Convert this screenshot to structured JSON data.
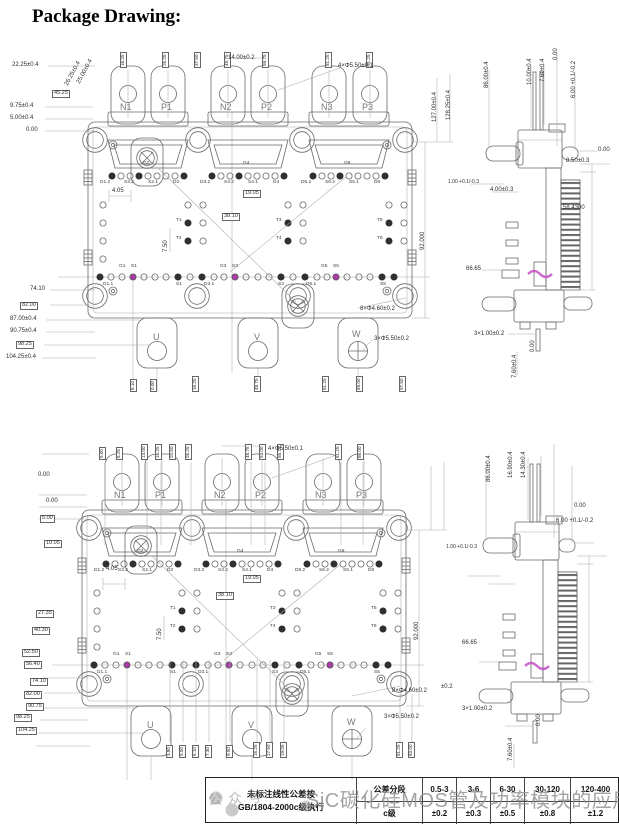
{
  "title": "Package Drawing:",
  "watermark": {
    "text": "SiC碳化硅MOS管及功率模块的应用",
    "stamp": "公众号"
  },
  "tolerance_table": {
    "note_line1": "未标注线性公差按",
    "note_line2": "GB/1804-2000c级执行",
    "header_line1": "公差分段",
    "header_line2": "c级",
    "columns": [
      {
        "range": "0.5-3",
        "tol": "±0.2"
      },
      {
        "range": "3-6",
        "tol": "±0.3"
      },
      {
        "range": "6-30",
        "tol": "±0.5"
      },
      {
        "range": "30-120",
        "tol": "±0.8"
      },
      {
        "range": "120-400",
        "tol": "±1.2"
      }
    ]
  },
  "drawing_top": {
    "labels": [
      {
        "t": "N1",
        "x": 120,
        "y": 103,
        "c": "term",
        "n": "terminal-n1"
      },
      {
        "t": "P1",
        "x": 161,
        "y": 103,
        "c": "term",
        "n": "terminal-p1"
      },
      {
        "t": "N2",
        "x": 220,
        "y": 103,
        "c": "term",
        "n": "terminal-n2"
      },
      {
        "t": "P2",
        "x": 261,
        "y": 103,
        "c": "term",
        "n": "terminal-p2"
      },
      {
        "t": "N3",
        "x": 321,
        "y": 103,
        "c": "term",
        "n": "terminal-n3"
      },
      {
        "t": "P3",
        "x": 362,
        "y": 103,
        "c": "term",
        "n": "terminal-p3"
      },
      {
        "t": "U",
        "x": 153,
        "y": 333,
        "c": "term",
        "n": "terminal-u"
      },
      {
        "t": "V",
        "x": 254,
        "y": 333,
        "c": "term",
        "n": "terminal-v"
      },
      {
        "t": "W",
        "x": 352,
        "y": 330,
        "c": "term",
        "n": "terminal-w"
      },
      {
        "t": "22.25±0.4",
        "x": 12,
        "y": 62,
        "c": "dim"
      },
      {
        "t": "26.25±0.4",
        "x": 64,
        "y": 84,
        "c": "dim",
        "r": -62
      },
      {
        "t": "25.00±0.4",
        "x": 76,
        "y": 82,
        "c": "dim",
        "r": -62
      },
      {
        "t": "45.25",
        "x": 52,
        "y": 90,
        "c": "dimbox"
      },
      {
        "t": "9.75±0.4",
        "x": 10,
        "y": 103,
        "c": "dim"
      },
      {
        "t": "5.00±0.4",
        "x": 10,
        "y": 115,
        "c": "dim"
      },
      {
        "t": "0.00",
        "x": 26,
        "y": 127,
        "c": "dim"
      },
      {
        "t": "74.10",
        "x": 30,
        "y": 286,
        "c": "dim"
      },
      {
        "t": "82.00",
        "x": 20,
        "y": 302,
        "c": "dimbox"
      },
      {
        "t": "87.00±0.4",
        "x": 10,
        "y": 316,
        "c": "dim"
      },
      {
        "t": "90.75±0.4",
        "x": 10,
        "y": 328,
        "c": "dim"
      },
      {
        "t": "98.25",
        "x": 16,
        "y": 341,
        "c": "dimbox"
      },
      {
        "t": "104.25±0.4",
        "x": 6,
        "y": 354,
        "c": "dim"
      },
      {
        "t": "16.25",
        "x": 120,
        "y": 68,
        "c": "vbox"
      },
      {
        "t": "26.25",
        "x": 162,
        "y": 68,
        "c": "vbox"
      },
      {
        "t": "37.50",
        "x": 194,
        "y": 68,
        "c": "vbox"
      },
      {
        "t": "48.75",
        "x": 224,
        "y": 68,
        "c": "vbox"
      },
      {
        "t": "58.75",
        "x": 262,
        "y": 68,
        "c": "vbox"
      },
      {
        "t": "81.25",
        "x": 325,
        "y": 68,
        "c": "vbox"
      },
      {
        "t": "91.25",
        "x": 366,
        "y": 68,
        "c": "vbox"
      },
      {
        "t": "14.00±0.2",
        "x": 228,
        "y": 55,
        "c": "dim"
      },
      {
        "t": "4×Φ5.50±0.1",
        "x": 338,
        "y": 63,
        "c": "dim"
      },
      {
        "t": "127.00±0.4",
        "x": 432,
        "y": 122,
        "c": "dim",
        "r": -90
      },
      {
        "t": "128.25±0.4",
        "x": 446,
        "y": 120,
        "c": "dim",
        "r": -90
      },
      {
        "t": "92.000",
        "x": 420,
        "y": 250,
        "c": "dim",
        "r": -90
      },
      {
        "t": "4.05",
        "x": 112,
        "y": 188,
        "c": "dim"
      },
      {
        "t": "7.50",
        "x": 163,
        "y": 252,
        "c": "dim",
        "r": -90
      },
      {
        "t": "19.05",
        "x": 243,
        "y": 190,
        "c": "dimbox"
      },
      {
        "t": "38.10",
        "x": 222,
        "y": 213,
        "c": "dimbox"
      },
      {
        "t": "G2",
        "x": 143,
        "y": 162,
        "c": "pin"
      },
      {
        "t": "G4",
        "x": 243,
        "y": 162,
        "c": "pin"
      },
      {
        "t": "G6",
        "x": 344,
        "y": 162,
        "c": "pin"
      },
      {
        "t": "D1.2",
        "x": 100,
        "y": 181,
        "c": "pin"
      },
      {
        "t": "S3.2",
        "x": 124,
        "y": 181,
        "c": "pin"
      },
      {
        "t": "S2.1",
        "x": 148,
        "y": 181,
        "c": "pin"
      },
      {
        "t": "D2",
        "x": 173,
        "y": 181,
        "c": "pin"
      },
      {
        "t": "D3.2",
        "x": 200,
        "y": 181,
        "c": "pin"
      },
      {
        "t": "S4.2",
        "x": 224,
        "y": 181,
        "c": "pin"
      },
      {
        "t": "S4.1",
        "x": 248,
        "y": 181,
        "c": "pin"
      },
      {
        "t": "D4",
        "x": 273,
        "y": 181,
        "c": "pin"
      },
      {
        "t": "D5.2",
        "x": 301,
        "y": 181,
        "c": "pin"
      },
      {
        "t": "S6.2",
        "x": 325,
        "y": 181,
        "c": "pin"
      },
      {
        "t": "S5.1",
        "x": 349,
        "y": 181,
        "c": "pin"
      },
      {
        "t": "D6",
        "x": 374,
        "y": 181,
        "c": "pin"
      },
      {
        "t": "T1",
        "x": 176,
        "y": 219,
        "c": "pin"
      },
      {
        "t": "T2",
        "x": 176,
        "y": 237,
        "c": "pin"
      },
      {
        "t": "T3",
        "x": 276,
        "y": 219,
        "c": "pin"
      },
      {
        "t": "T4",
        "x": 276,
        "y": 237,
        "c": "pin"
      },
      {
        "t": "T5",
        "x": 377,
        "y": 219,
        "c": "pin"
      },
      {
        "t": "T6",
        "x": 377,
        "y": 237,
        "c": "pin"
      },
      {
        "t": "G1",
        "x": 119,
        "y": 265,
        "c": "pin"
      },
      {
        "t": "S1",
        "x": 131,
        "y": 265,
        "c": "pin"
      },
      {
        "t": "G3",
        "x": 220,
        "y": 265,
        "c": "pin"
      },
      {
        "t": "S3",
        "x": 232,
        "y": 265,
        "c": "pin"
      },
      {
        "t": "G5",
        "x": 321,
        "y": 265,
        "c": "pin"
      },
      {
        "t": "S5",
        "x": 333,
        "y": 265,
        "c": "pin"
      },
      {
        "t": "D1.1",
        "x": 103,
        "y": 283,
        "c": "pin"
      },
      {
        "t": "S1",
        "x": 176,
        "y": 283,
        "c": "pin"
      },
      {
        "t": "D3.1",
        "x": 204,
        "y": 283,
        "c": "pin"
      },
      {
        "t": "S3",
        "x": 278,
        "y": 283,
        "c": "pin"
      },
      {
        "t": "D5.1",
        "x": 306,
        "y": 283,
        "c": "pin"
      },
      {
        "t": "S5",
        "x": 380,
        "y": 283,
        "c": "pin"
      },
      {
        "t": "8×Φ4.60±0.2",
        "x": 360,
        "y": 306,
        "c": "dim"
      },
      {
        "t": "3×Φ5.50±0.2",
        "x": 374,
        "y": 336,
        "c": "dim"
      },
      {
        "t": "6.10",
        "x": 130,
        "y": 392,
        "c": "vbox"
      },
      {
        "t": "0.00",
        "x": 150,
        "y": 392,
        "c": "vbox"
      },
      {
        "t": "16.25",
        "x": 192,
        "y": 392,
        "c": "vbox"
      },
      {
        "t": "48.75",
        "x": 254,
        "y": 392,
        "c": "vbox"
      },
      {
        "t": "81.25",
        "x": 322,
        "y": 392,
        "c": "vbox"
      },
      {
        "t": "89.00",
        "x": 356,
        "y": 392,
        "c": "vbox"
      },
      {
        "t": "97.50",
        "x": 399,
        "y": 392,
        "c": "vbox"
      },
      {
        "t": "86.00±0.4",
        "x": 484,
        "y": 88,
        "c": "dim",
        "r": -90
      },
      {
        "t": "10.00±0.4",
        "x": 527,
        "y": 85,
        "c": "dim",
        "r": -90
      },
      {
        "t": "7.60±0.4",
        "x": 540,
        "y": 82,
        "c": "dim",
        "r": -90
      },
      {
        "t": "0.00",
        "x": 553,
        "y": 60,
        "c": "dim",
        "r": -90
      },
      {
        "t": "6.00 +0.1/-0.2",
        "x": 571,
        "y": 98,
        "c": "dim",
        "r": -90
      },
      {
        "t": "0.00",
        "x": 598,
        "y": 147,
        "c": "dim"
      },
      {
        "t": "8.50±0.3",
        "x": 566,
        "y": 158,
        "c": "dim"
      },
      {
        "t": "1.00 +0.1/-0.3",
        "x": 448,
        "y": 180,
        "c": "dims"
      },
      {
        "t": "4.00±0.3",
        "x": 490,
        "y": 187,
        "c": "dim"
      },
      {
        "t": "58.4300",
        "x": 563,
        "y": 205,
        "c": "dim"
      },
      {
        "t": "66.65",
        "x": 466,
        "y": 266,
        "c": "dim"
      },
      {
        "t": "3×1.00±0.2",
        "x": 474,
        "y": 331,
        "c": "dim"
      },
      {
        "t": "0.00",
        "x": 530,
        "y": 352,
        "c": "dim",
        "r": -90
      },
      {
        "t": "7.60±0.4",
        "x": 512,
        "y": 378,
        "c": "dim",
        "r": -90
      }
    ]
  },
  "drawing_bottom": {
    "labels": [
      {
        "t": "N1",
        "x": 114,
        "y": 491,
        "c": "term",
        "n": "terminal-n1"
      },
      {
        "t": "P1",
        "x": 155,
        "y": 491,
        "c": "term",
        "n": "terminal-p1"
      },
      {
        "t": "N2",
        "x": 214,
        "y": 491,
        "c": "term",
        "n": "terminal-n2"
      },
      {
        "t": "P2",
        "x": 255,
        "y": 491,
        "c": "term",
        "n": "terminal-p2"
      },
      {
        "t": "N3",
        "x": 315,
        "y": 491,
        "c": "term",
        "n": "terminal-n3"
      },
      {
        "t": "P3",
        "x": 356,
        "y": 491,
        "c": "term",
        "n": "terminal-p3"
      },
      {
        "t": "U",
        "x": 147,
        "y": 721,
        "c": "term",
        "n": "terminal-u"
      },
      {
        "t": "V",
        "x": 248,
        "y": 721,
        "c": "term",
        "n": "terminal-v"
      },
      {
        "t": "W",
        "x": 347,
        "y": 718,
        "c": "term",
        "n": "terminal-w"
      },
      {
        "t": "5.00",
        "x": 99,
        "y": 460,
        "c": "vbox"
      },
      {
        "t": "8.25",
        "x": 116,
        "y": 460,
        "c": "vbox"
      },
      {
        "t": "14.00",
        "x": 141,
        "y": 460,
        "c": "vbox"
      },
      {
        "t": "16.25",
        "x": 155,
        "y": 460,
        "c": "vbox"
      },
      {
        "t": "20.50",
        "x": 169,
        "y": 460,
        "c": "vbox"
      },
      {
        "t": "26.25",
        "x": 185,
        "y": 460,
        "c": "vbox"
      },
      {
        "t": "48.75",
        "x": 245,
        "y": 460,
        "c": "vbox"
      },
      {
        "t": "53.00",
        "x": 259,
        "y": 460,
        "c": "vbox"
      },
      {
        "t": "58.75",
        "x": 277,
        "y": 460,
        "c": "vbox"
      },
      {
        "t": "81.25",
        "x": 335,
        "y": 460,
        "c": "vbox"
      },
      {
        "t": "86.00",
        "x": 357,
        "y": 460,
        "c": "vbox"
      },
      {
        "t": "4×Φ5.50±0.1",
        "x": 268,
        "y": 446,
        "c": "dim"
      },
      {
        "t": "0.00",
        "x": 38,
        "y": 472,
        "c": "dim"
      },
      {
        "t": "0.00",
        "x": 46,
        "y": 498,
        "c": "dim"
      },
      {
        "t": "5.00",
        "x": 40,
        "y": 515,
        "c": "dimbox"
      },
      {
        "t": "10.05",
        "x": 44,
        "y": 540,
        "c": "dimbox"
      },
      {
        "t": "27.35",
        "x": 36,
        "y": 610,
        "c": "dimbox"
      },
      {
        "t": "40.30",
        "x": 32,
        "y": 627,
        "c": "dimbox"
      },
      {
        "t": "52.50",
        "x": 22,
        "y": 649,
        "c": "dimbox"
      },
      {
        "t": "56.40",
        "x": 24,
        "y": 661,
        "c": "dimbox"
      },
      {
        "t": "74.10",
        "x": 30,
        "y": 678,
        "c": "dimbox"
      },
      {
        "t": "82.00",
        "x": 24,
        "y": 691,
        "c": "dimbox"
      },
      {
        "t": "90.75",
        "x": 26,
        "y": 703,
        "c": "dimbox"
      },
      {
        "t": "98.25",
        "x": 14,
        "y": 714,
        "c": "dimbox"
      },
      {
        "t": "104.25",
        "x": 16,
        "y": 727,
        "c": "dimbox"
      },
      {
        "t": "4.05",
        "x": 106,
        "y": 566,
        "c": "dim"
      },
      {
        "t": "7.50",
        "x": 157,
        "y": 640,
        "c": "dim",
        "r": -90
      },
      {
        "t": "19.05",
        "x": 243,
        "y": 575,
        "c": "dimbox"
      },
      {
        "t": "38.10",
        "x": 216,
        "y": 592,
        "c": "dimbox"
      },
      {
        "t": "G2",
        "x": 137,
        "y": 550,
        "c": "pin"
      },
      {
        "t": "G4",
        "x": 237,
        "y": 550,
        "c": "pin"
      },
      {
        "t": "G6",
        "x": 338,
        "y": 550,
        "c": "pin"
      },
      {
        "t": "D1.2",
        "x": 94,
        "y": 569,
        "c": "pin"
      },
      {
        "t": "S3.2",
        "x": 118,
        "y": 569,
        "c": "pin"
      },
      {
        "t": "S2.1",
        "x": 142,
        "y": 569,
        "c": "pin"
      },
      {
        "t": "D2",
        "x": 167,
        "y": 569,
        "c": "pin"
      },
      {
        "t": "D3.2",
        "x": 194,
        "y": 569,
        "c": "pin"
      },
      {
        "t": "S4.2",
        "x": 218,
        "y": 569,
        "c": "pin"
      },
      {
        "t": "S4.1",
        "x": 242,
        "y": 569,
        "c": "pin"
      },
      {
        "t": "D4",
        "x": 267,
        "y": 569,
        "c": "pin"
      },
      {
        "t": "D5.2",
        "x": 295,
        "y": 569,
        "c": "pin"
      },
      {
        "t": "S6.2",
        "x": 319,
        "y": 569,
        "c": "pin"
      },
      {
        "t": "S5.1",
        "x": 343,
        "y": 569,
        "c": "pin"
      },
      {
        "t": "D6",
        "x": 368,
        "y": 569,
        "c": "pin"
      },
      {
        "t": "T1",
        "x": 170,
        "y": 607,
        "c": "pin"
      },
      {
        "t": "T2",
        "x": 170,
        "y": 625,
        "c": "pin"
      },
      {
        "t": "T3",
        "x": 270,
        "y": 607,
        "c": "pin"
      },
      {
        "t": "T4",
        "x": 270,
        "y": 625,
        "c": "pin"
      },
      {
        "t": "T5",
        "x": 371,
        "y": 607,
        "c": "pin"
      },
      {
        "t": "T6",
        "x": 371,
        "y": 625,
        "c": "pin"
      },
      {
        "t": "G1",
        "x": 113,
        "y": 653,
        "c": "pin"
      },
      {
        "t": "S1",
        "x": 125,
        "y": 653,
        "c": "pin"
      },
      {
        "t": "G3",
        "x": 214,
        "y": 653,
        "c": "pin"
      },
      {
        "t": "S3",
        "x": 226,
        "y": 653,
        "c": "pin"
      },
      {
        "t": "G5",
        "x": 315,
        "y": 653,
        "c": "pin"
      },
      {
        "t": "S5",
        "x": 327,
        "y": 653,
        "c": "pin"
      },
      {
        "t": "D1.1",
        "x": 97,
        "y": 671,
        "c": "pin"
      },
      {
        "t": "S1",
        "x": 170,
        "y": 671,
        "c": "pin"
      },
      {
        "t": "D3.1",
        "x": 198,
        "y": 671,
        "c": "pin"
      },
      {
        "t": "S3",
        "x": 272,
        "y": 671,
        "c": "pin"
      },
      {
        "t": "D5.1",
        "x": 300,
        "y": 671,
        "c": "pin"
      },
      {
        "t": "S5",
        "x": 374,
        "y": 671,
        "c": "pin"
      },
      {
        "t": "8×Φ4.60±0.2",
        "x": 392,
        "y": 688,
        "c": "dim"
      },
      {
        "t": "3×Φ5.50±0.2",
        "x": 384,
        "y": 714,
        "c": "dim"
      },
      {
        "t": "92.000",
        "x": 414,
        "y": 640,
        "c": "dim",
        "r": -90
      },
      {
        "t": "3.80",
        "x": 166,
        "y": 758,
        "c": "vbox"
      },
      {
        "t": "5.00",
        "x": 179,
        "y": 758,
        "c": "vbox"
      },
      {
        "t": "6.10",
        "x": 192,
        "y": 758,
        "c": "vbox"
      },
      {
        "t": "7.30",
        "x": 205,
        "y": 758,
        "c": "vbox"
      },
      {
        "t": "9.50",
        "x": 226,
        "y": 758,
        "c": "vbox"
      },
      {
        "t": "16.25",
        "x": 253,
        "y": 758,
        "c": "vbox"
      },
      {
        "t": "17.50",
        "x": 266,
        "y": 758,
        "c": "vbox"
      },
      {
        "t": "19.05",
        "x": 280,
        "y": 758,
        "c": "vbox"
      },
      {
        "t": "81.25",
        "x": 396,
        "y": 758,
        "c": "vbox"
      },
      {
        "t": "83.00",
        "x": 408,
        "y": 758,
        "c": "vbox"
      },
      {
        "t": "86.00±0.4",
        "x": 486,
        "y": 482,
        "c": "dim",
        "r": -90
      },
      {
        "t": "16.90±0.4",
        "x": 508,
        "y": 478,
        "c": "dim",
        "r": -90
      },
      {
        "t": "14.30±0.4",
        "x": 521,
        "y": 478,
        "c": "dim",
        "r": -90
      },
      {
        "t": "0.00",
        "x": 574,
        "y": 503,
        "c": "dim"
      },
      {
        "t": "6.00 +0.1/-0.2",
        "x": 556,
        "y": 518,
        "c": "dim"
      },
      {
        "t": "1.00 +0.1/-0.3",
        "x": 446,
        "y": 545,
        "c": "dims"
      },
      {
        "t": "66.65",
        "x": 462,
        "y": 640,
        "c": "dim"
      },
      {
        "t": "±0.2",
        "x": 441,
        "y": 684,
        "c": "dim"
      },
      {
        "t": "3×1.00±0.2",
        "x": 462,
        "y": 706,
        "c": "dim"
      },
      {
        "t": "0.00",
        "x": 536,
        "y": 726,
        "c": "dim",
        "r": -90
      },
      {
        "t": "7.60±0.4",
        "x": 508,
        "y": 761,
        "c": "dim",
        "r": -90
      }
    ]
  }
}
